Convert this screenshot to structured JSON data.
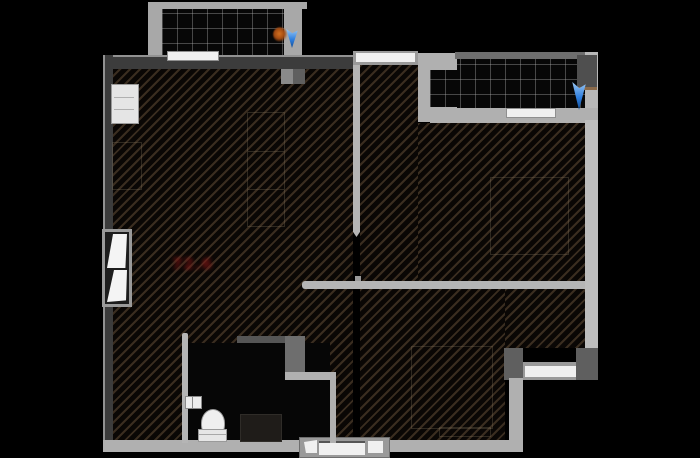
{
  "title": "apartment-floor-plan",
  "labels": {
    "area_label": "72.6"
  },
  "markers": {
    "balcony_left_pointer": "blue-pointer",
    "balcony_right_pointer": "blue-pointer",
    "balcony_left_dot": "orange-dot"
  },
  "palette": {
    "background": "#000000",
    "wall_light": "#b5b5b5",
    "wall_mid": "#6e6e6e",
    "wall_dark": "#3c3c3c",
    "window_white": "#f0f0f0",
    "arrow_color": "#2e7fe0",
    "orange_dot_color": "#a14a12",
    "area_label_color": "#8c1616"
  },
  "rooms": {
    "living_area": {
      "floor": "diagonal-hatch"
    },
    "bedroom_top_right": {
      "floor": "diagonal-hatch"
    },
    "bedroom_bottom_right": {
      "floor": "diagonal-hatch"
    },
    "bathroom": {
      "floor": "plain-dark",
      "fixtures": [
        "toilet",
        "shower-tray",
        "wall-fixture"
      ]
    },
    "balcony_top_left": {
      "floor": "tile-grid"
    },
    "balcony_top_right": {
      "floor": "tile-grid",
      "fixtures": [
        "ac-unit"
      ]
    }
  }
}
